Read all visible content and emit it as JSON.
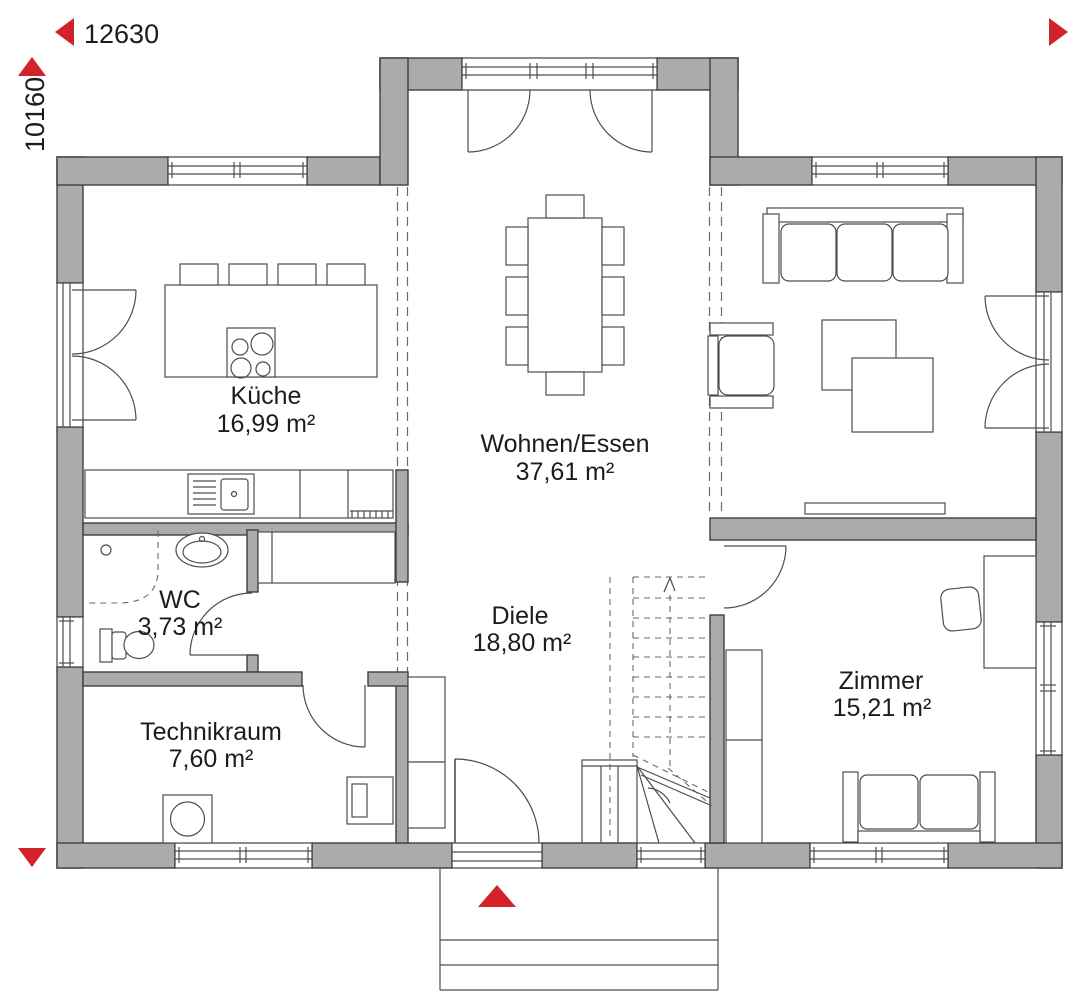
{
  "dimension_labels": {
    "horizontal": "12630",
    "vertical": "10160"
  },
  "rooms": {
    "kueche": {
      "name": "Küche",
      "area": "16,99 m²"
    },
    "wohnen_essen": {
      "name": "Wohnen/Essen",
      "area": "37,61 m²"
    },
    "wc": {
      "name": "WC",
      "area": "3,73 m²"
    },
    "diele": {
      "name": "Diele",
      "area": "18,80 m²"
    },
    "technikraum": {
      "name": "Technikraum",
      "area": "7,60 m²"
    },
    "zimmer": {
      "name": "Zimmer",
      "area": "15,21 m²"
    }
  },
  "markers": {
    "entrance_arrow": "up-triangle",
    "dim_arrow_left": "left-triangle",
    "dim_arrow_right": "right-triangle",
    "dim_arrow_top": "up-triangle",
    "dim_arrow_bottom": "down-triangle"
  },
  "colors": {
    "wall_fill": "#ababab",
    "wall_outline": "#3f3f3f",
    "line": "#4d4d4d",
    "dashed_line": "#6a6a6a",
    "accent_red": "#d2232a",
    "text": "#1c1c1c",
    "background": "#ffffff"
  }
}
